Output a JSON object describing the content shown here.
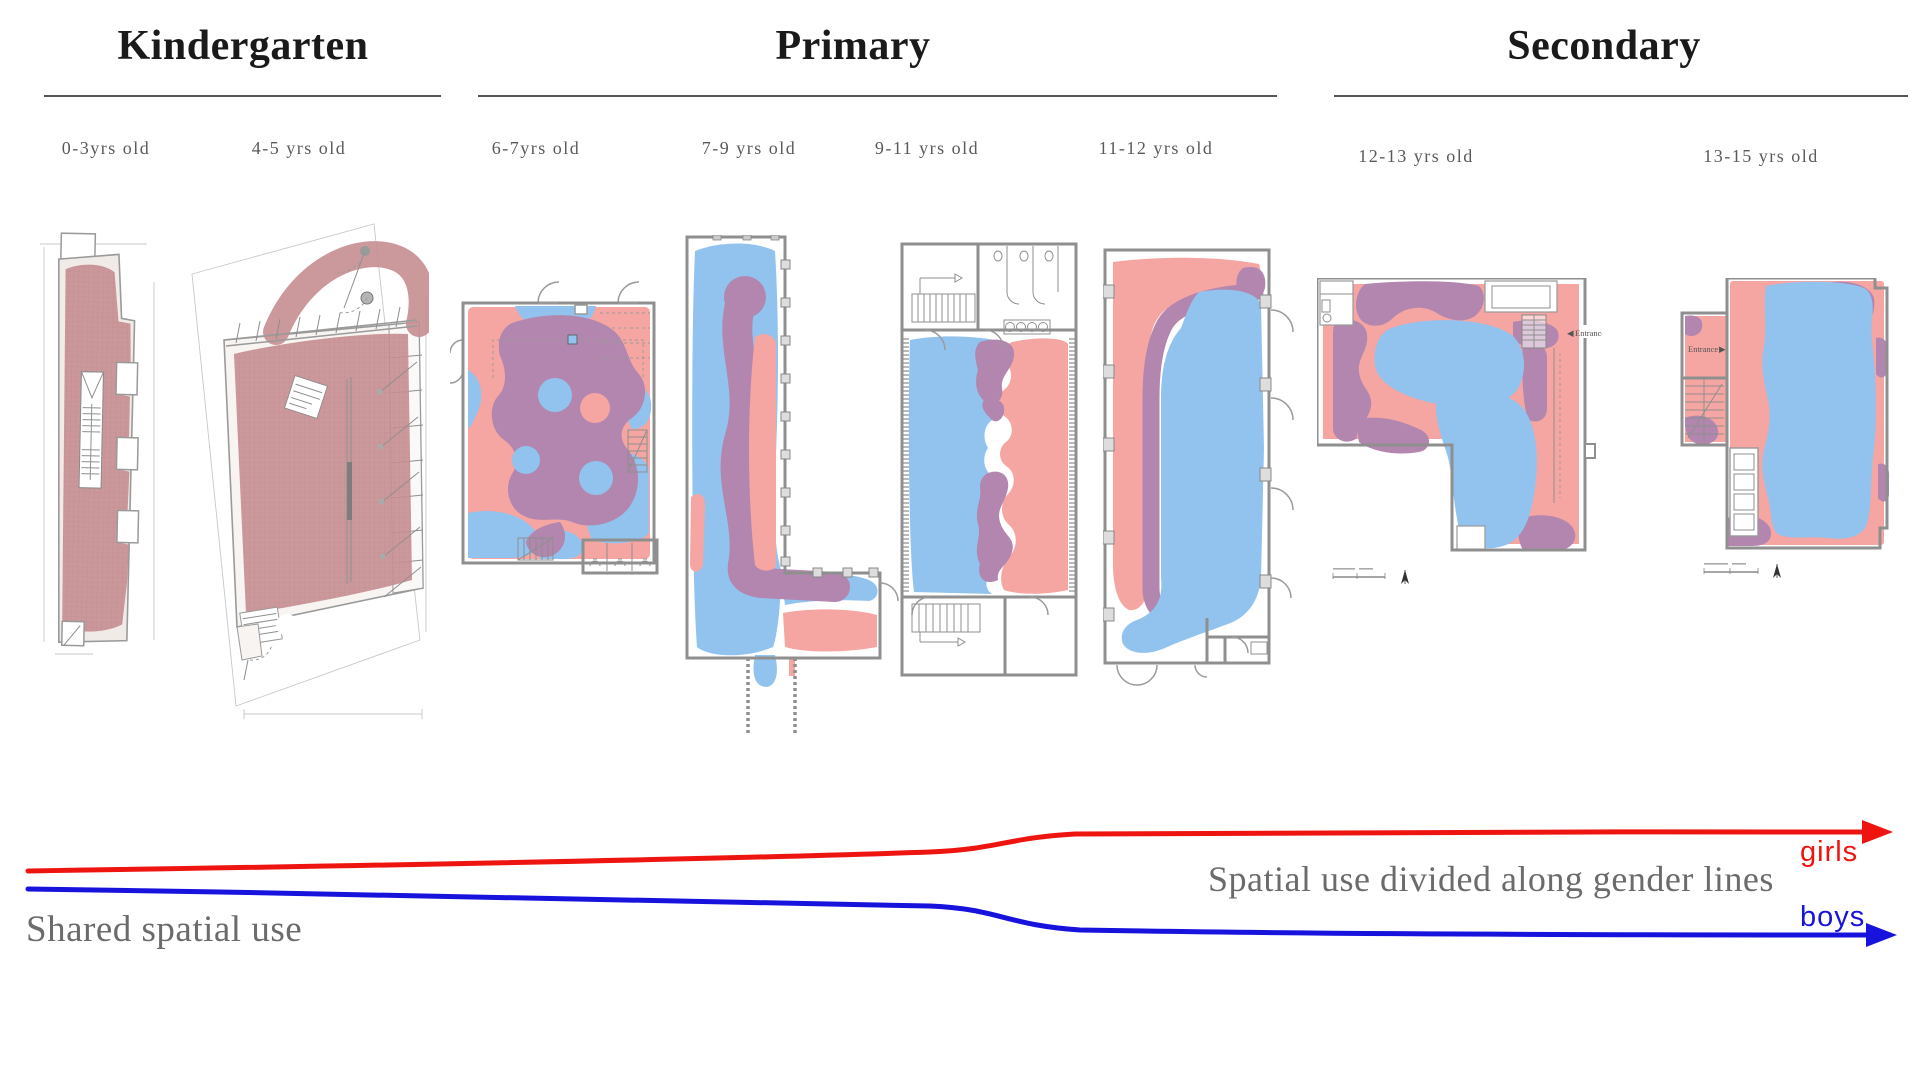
{
  "sections": {
    "kindergarten": "Kindergarten",
    "primary": "Primary",
    "secondary": "Secondary"
  },
  "age_labels": [
    "0-3yrs old",
    "4-5 yrs old",
    "6-7yrs old",
    "7-9 yrs old",
    "9-11 yrs old",
    "11-12 yrs old",
    "12-13 yrs old",
    "13-15 yrs old"
  ],
  "plan_annotations": {
    "entrance_secondary_1": "Entrance",
    "entrance_secondary_2": "Entrance"
  },
  "icons": {
    "entrance_arrow_left": "◀",
    "entrance_arrow_right": "▶"
  },
  "timeline": {
    "shared": "Shared spatial use",
    "divided": "Spatial use divided along gender lines",
    "girls": "girls",
    "boys": "boys"
  },
  "colors": {
    "pink": "#f5a5a2",
    "blue": "#92c3ef",
    "pur": "#b286ae",
    "rose": "#c78f94",
    "girls": "#ee1511",
    "boys": "#1812dd",
    "wall": "#8f8f8f",
    "heading": "#1a1a1a",
    "muted": "#5a5a5a",
    "caption": "#6b6b6b",
    "rule": "#555555",
    "planbg": "#f1ebe7"
  }
}
